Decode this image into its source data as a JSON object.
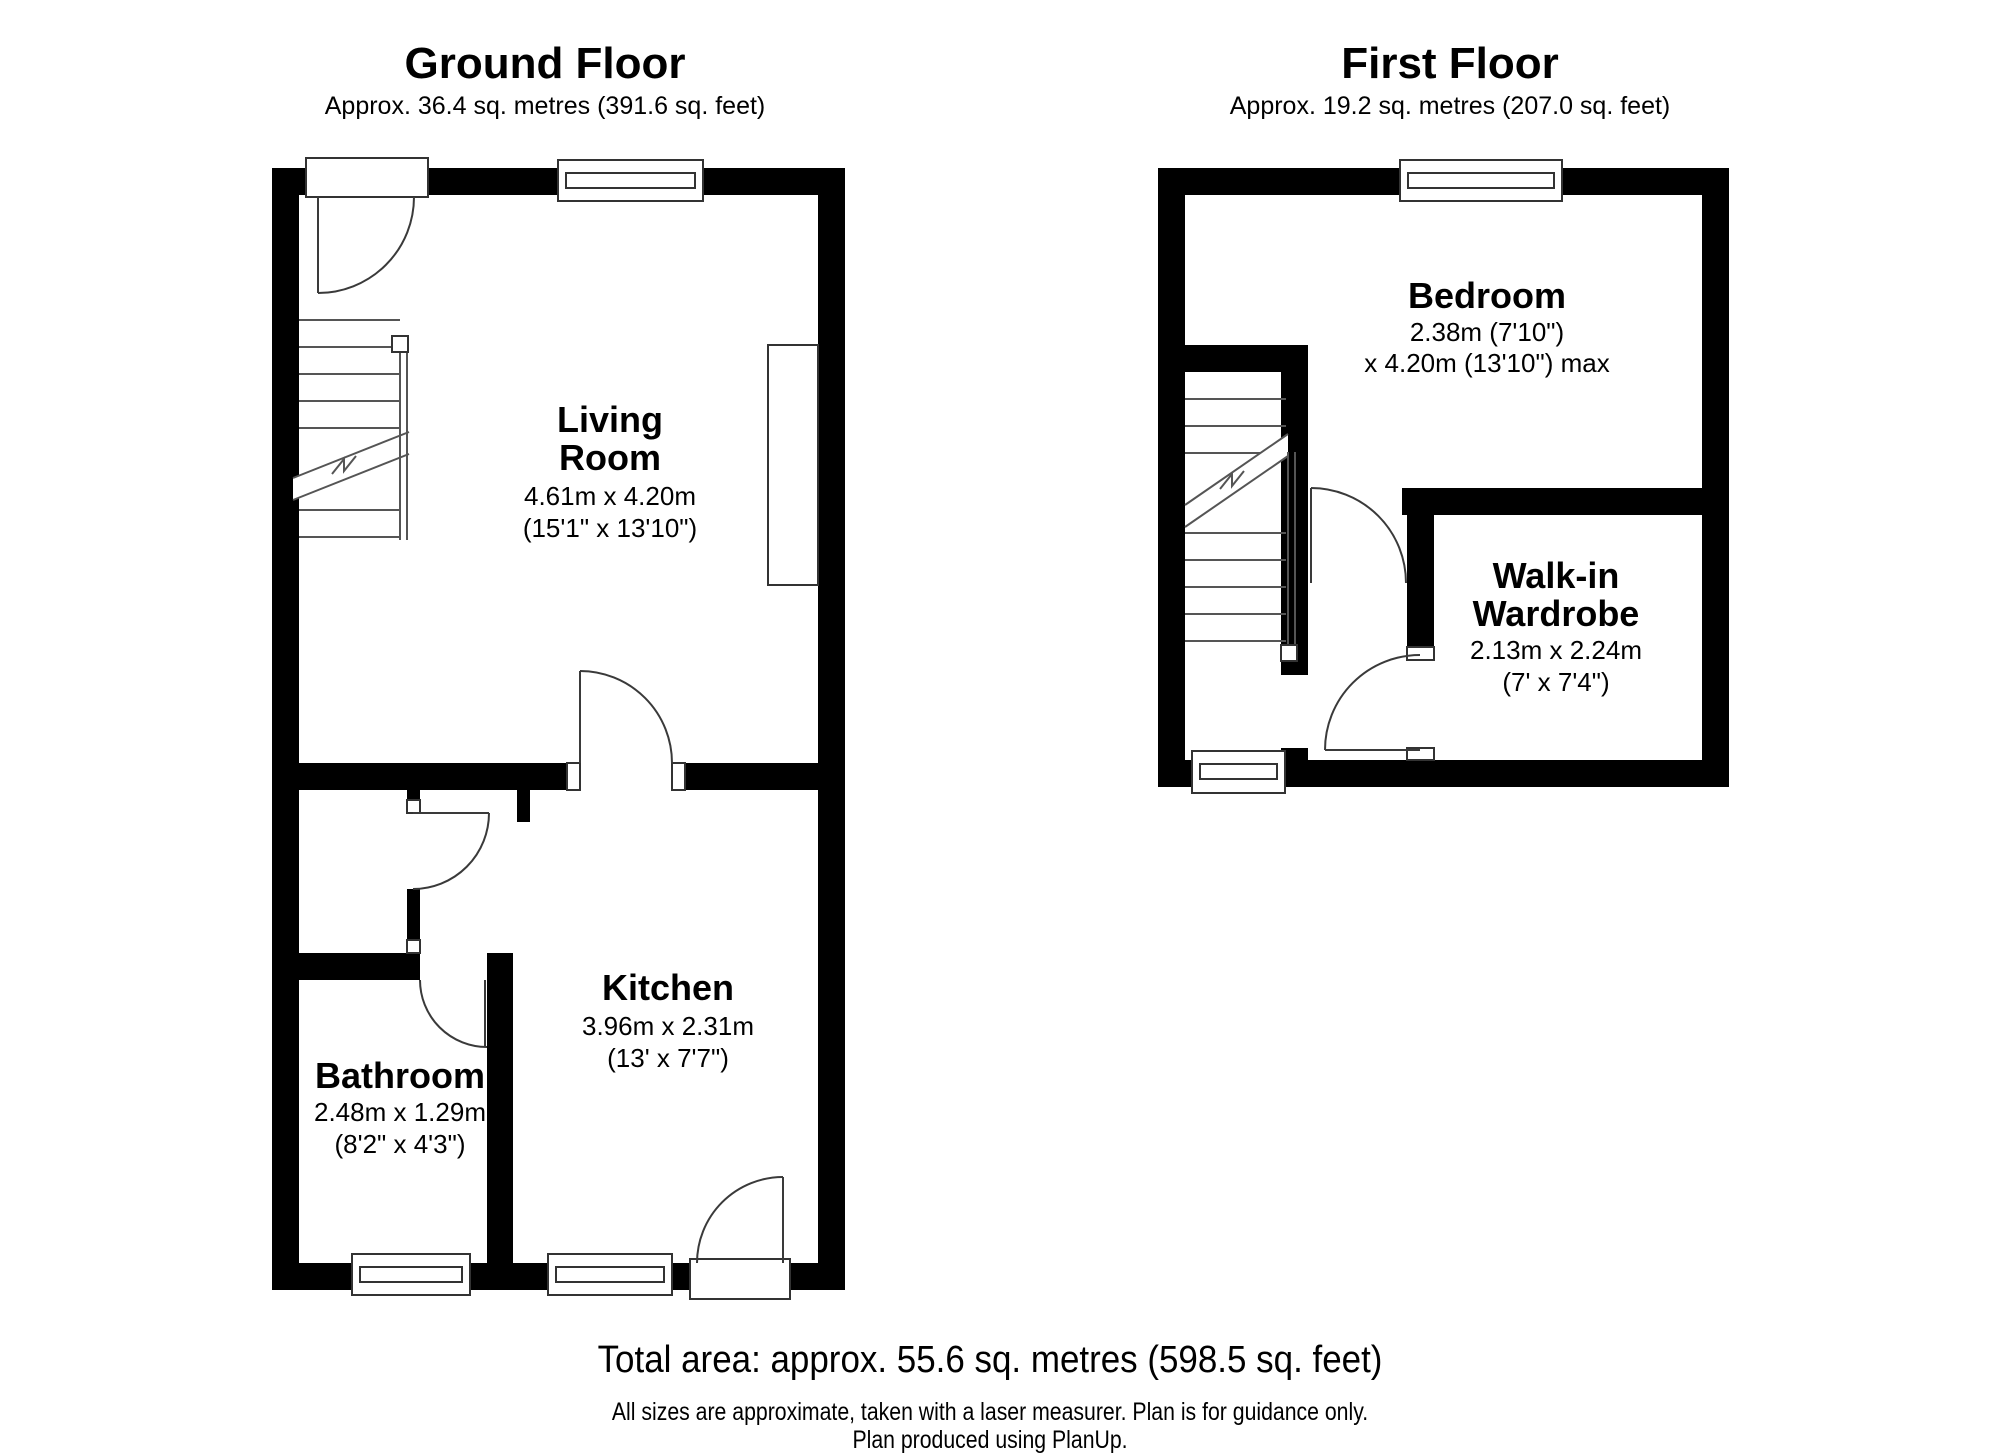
{
  "ground_floor": {
    "title": "Ground Floor",
    "area": "Approx. 36.4 sq. metres (391.6 sq. feet)",
    "rooms": {
      "living": {
        "name1": "Living",
        "name2": "Room",
        "metric": "4.61m x 4.20m",
        "imperial": "(15'1\" x 13'10\")"
      },
      "kitchen": {
        "name": "Kitchen",
        "metric": "3.96m x 2.31m",
        "imperial": "(13' x 7'7\")"
      },
      "bathroom": {
        "name": "Bathroom",
        "metric": "2.48m x 1.29m",
        "imperial": "(8'2\" x 4'3\")"
      }
    }
  },
  "first_floor": {
    "title": "First Floor",
    "area": "Approx. 19.2 sq. metres (207.0 sq. feet)",
    "rooms": {
      "bedroom": {
        "name": "Bedroom",
        "metric": "2.38m (7'10\")",
        "imperial": "x 4.20m (13'10\") max"
      },
      "wardrobe": {
        "name1": "Walk-in",
        "name2": "Wardrobe",
        "metric": "2.13m x 2.24m",
        "imperial": "(7' x 7'4\")"
      }
    }
  },
  "footer": {
    "total": "Total area: approx. 55.6 sq. metres (598.5 sq. feet)",
    "disclaimer": "All sizes are approximate, taken with a laser measurer. Plan is for guidance only.",
    "credit": "Plan produced using PlanUp."
  },
  "colors": {
    "wall": "#000000",
    "line": "#3a3a3a",
    "background": "#ffffff",
    "text": "#000000"
  }
}
